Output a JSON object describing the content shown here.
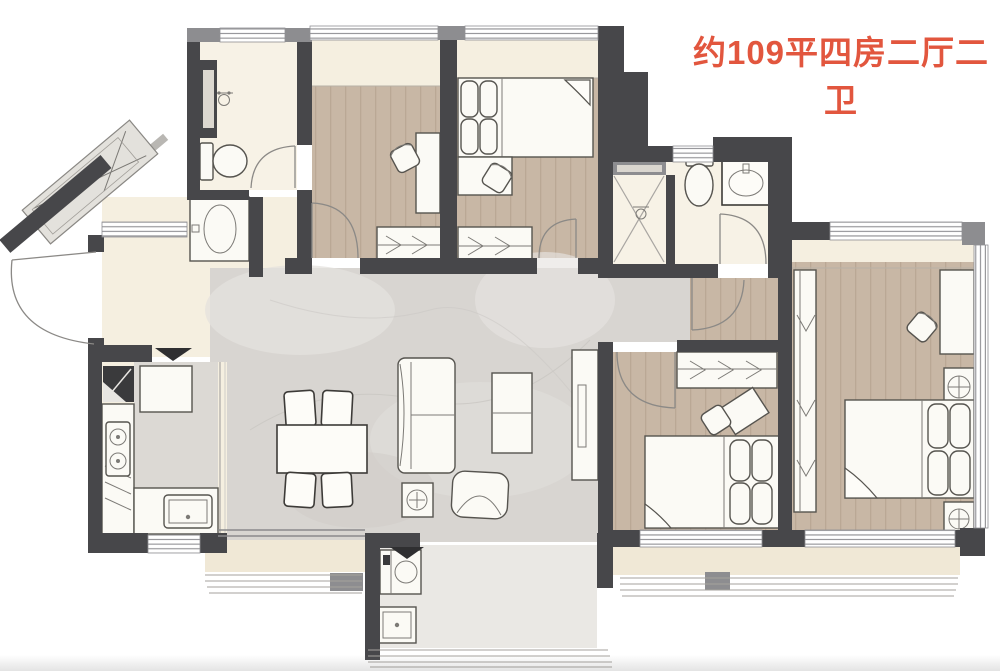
{
  "title": {
    "text": "约109平四房二厅二卫"
  },
  "palette": {
    "accent": "#e2563e",
    "wall": "#47474a",
    "wallmid": "#8d8d90",
    "wood": "#c8b7a5",
    "marble": "#d8d5d1",
    "cream": "#f5efe0",
    "bath": "#f7f2e6",
    "balcony": "#f0e8d6",
    "laundry": "#eae8e4",
    "tile": "#dcd9d4",
    "furnstroke": "#56544f"
  },
  "plan": {
    "type": "apartment-floor-plan",
    "area_label": "约109平",
    "layout_label": "四房二厅二卫",
    "rooms": [
      {
        "name": "entry",
        "furniture": [
          "entry-door",
          "entry-closet"
        ]
      },
      {
        "name": "bathroom-1",
        "furniture": [
          "shower",
          "toilet",
          "vanity-sink"
        ]
      },
      {
        "name": "bedroom-2",
        "furniture": [
          "desk",
          "chair",
          "wardrobe"
        ]
      },
      {
        "name": "bedroom-3",
        "furniture": [
          "bed",
          "desk",
          "chair",
          "wardrobe"
        ]
      },
      {
        "name": "bathroom-2",
        "furniture": [
          "shower",
          "toilet",
          "sink"
        ]
      },
      {
        "name": "master-bedroom",
        "furniture": [
          "bed",
          "nightstand",
          "nightstand",
          "desk",
          "chair",
          "wardrobe"
        ]
      },
      {
        "name": "bedroom-4",
        "furniture": [
          "bed",
          "desk",
          "chair",
          "wardrobe"
        ]
      },
      {
        "name": "living-dining-room",
        "furniture": [
          "dining-table",
          "dining-chairs",
          "sofa",
          "coffee-table",
          "armchair",
          "console",
          "tv-cabinet"
        ]
      },
      {
        "name": "kitchen",
        "furniture": [
          "fridge",
          "counter",
          "stove",
          "sink"
        ]
      },
      {
        "name": "laundry-balcony",
        "furniture": [
          "washing-machine",
          "laundry-sink"
        ]
      },
      {
        "name": "balcony",
        "furniture": []
      }
    ]
  }
}
